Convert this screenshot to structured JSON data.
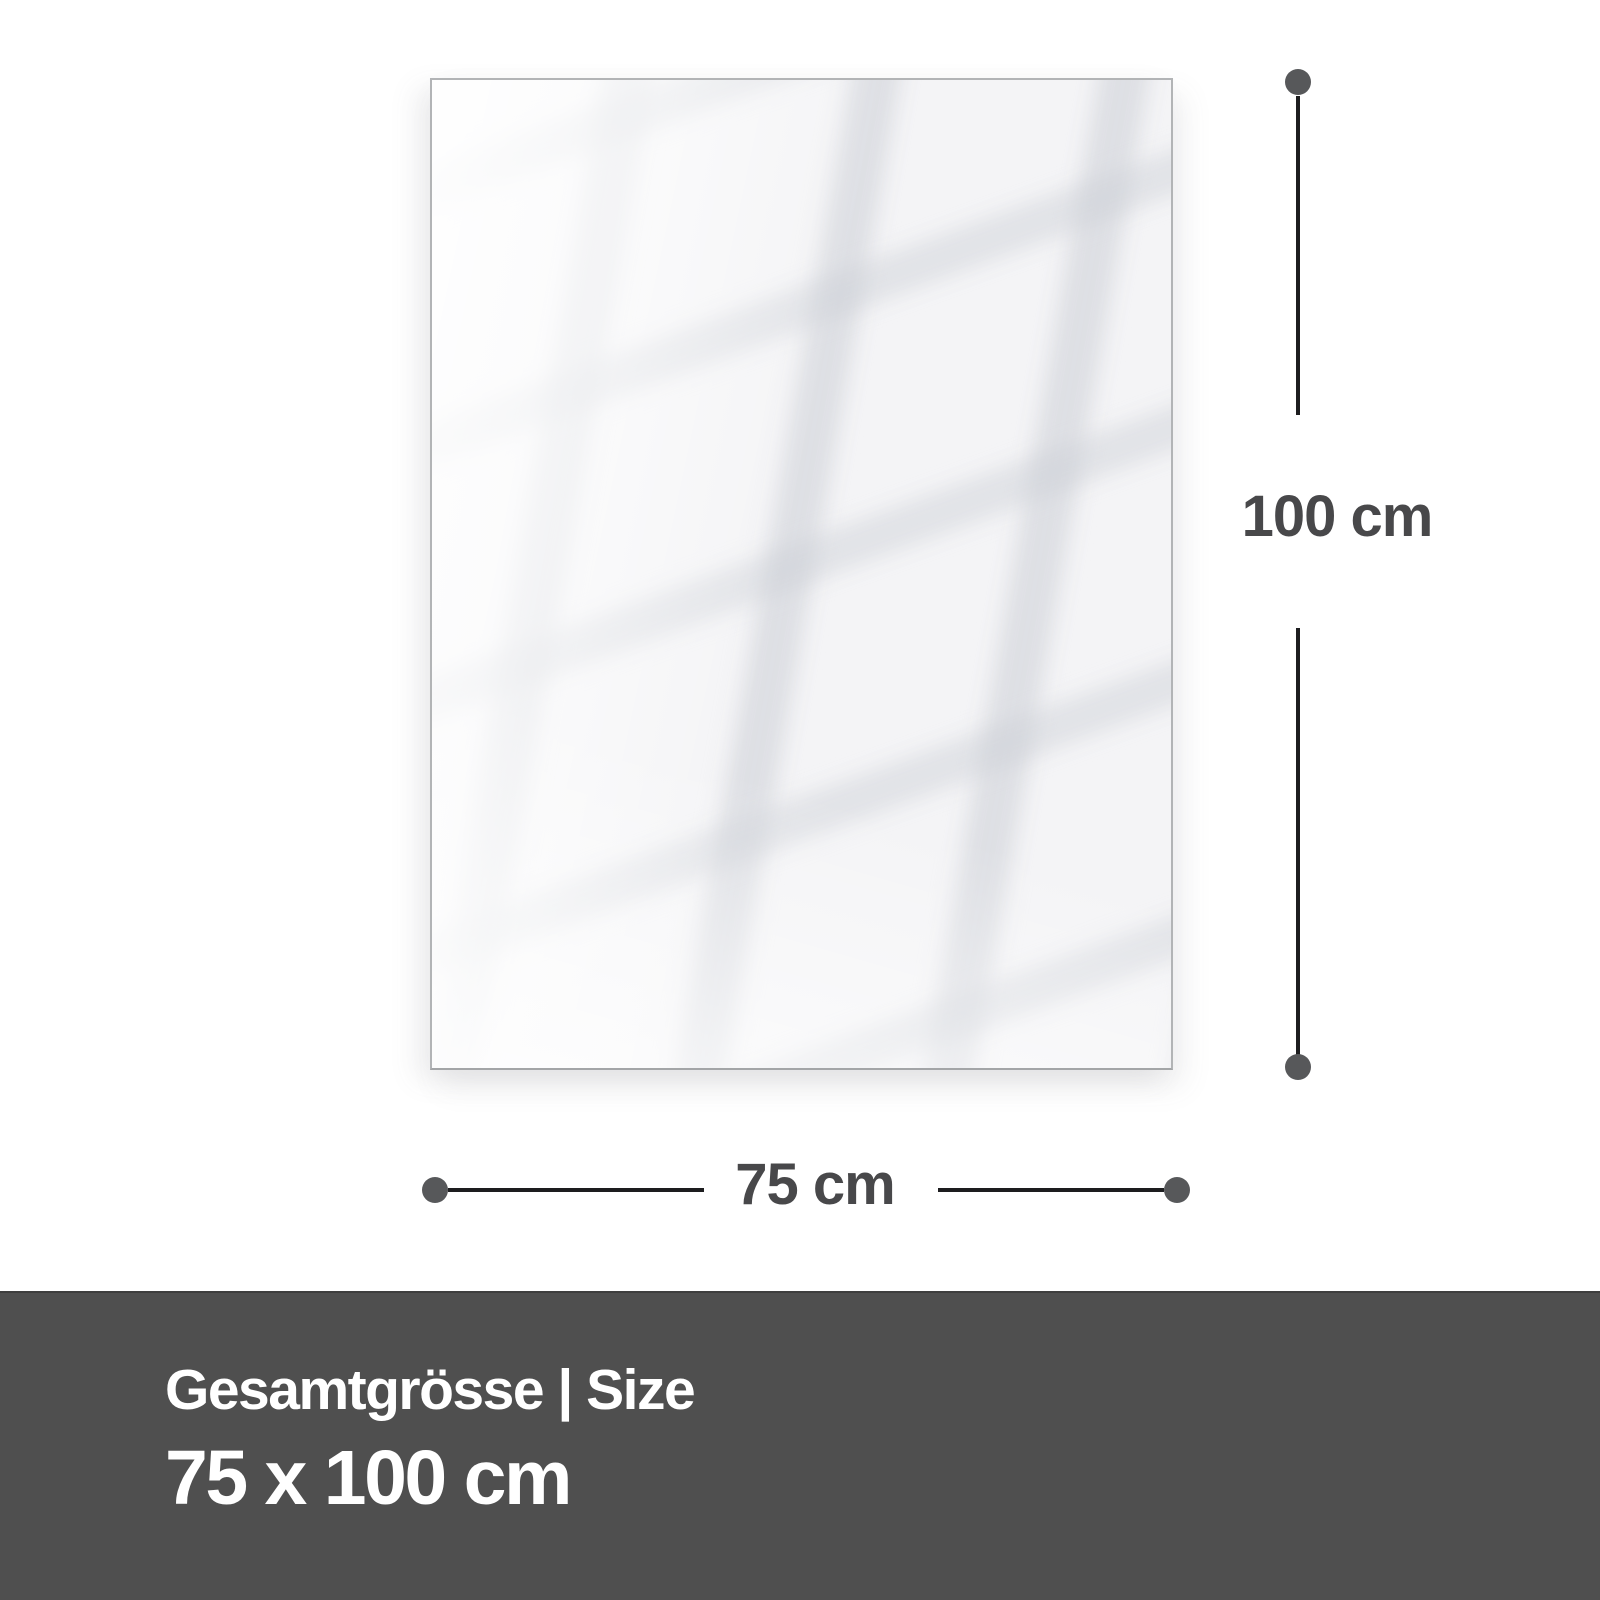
{
  "product_diagram": {
    "dimensions": {
      "height_label": "100 cm",
      "width_label": "75 cm"
    },
    "footer": {
      "title": "Gesamtgrösse | Size",
      "size_value": "75 x 100 cm"
    },
    "colors": {
      "background": "#ffffff",
      "panel_fill": "#f4f4f6",
      "panel_border": "#b2b4b6",
      "dimension_line": "#1d1d1f",
      "dimension_dot": "#57585a",
      "dimension_text": "#48484a",
      "footer_bg": "#4f4f4f",
      "footer_border_top": "#3e3e3e",
      "footer_text": "#ffffff"
    }
  }
}
